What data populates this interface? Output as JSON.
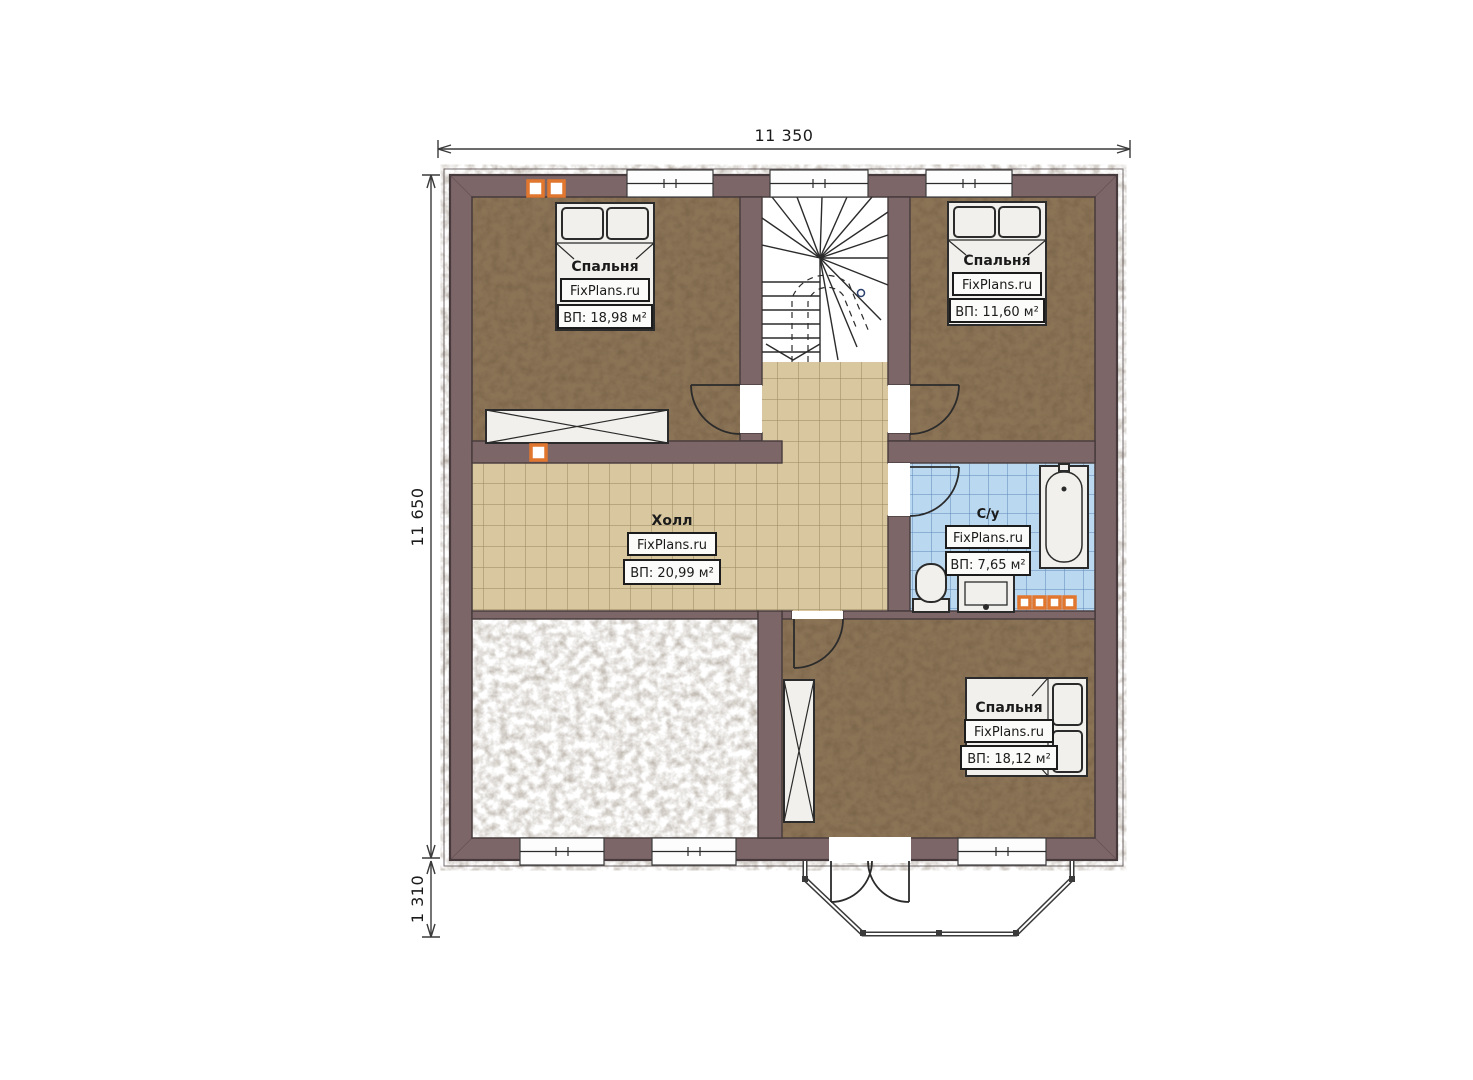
{
  "plan": {
    "dimensions": {
      "top": "11 350",
      "left": "11 650",
      "bottom": "1 310"
    },
    "rooms": [
      {
        "key": "bedroom_top_left",
        "name": "Спальня",
        "brand": "FixPlans.ru",
        "area": "ВП: 18,98 м²"
      },
      {
        "key": "bedroom_top_right",
        "name": "Спальня",
        "brand": "FixPlans.ru",
        "area": "ВП: 11,60 м²"
      },
      {
        "key": "hall",
        "name": "Холл",
        "brand": "FixPlans.ru",
        "area": "ВП: 20,99 м²"
      },
      {
        "key": "bathroom",
        "name": "С/у",
        "brand": "FixPlans.ru",
        "area": "ВП: 7,65 м²"
      },
      {
        "key": "bedroom_bottom_right",
        "name": "Спальня",
        "brand": "FixPlans.ru",
        "area": "ВП: 18,12 м²"
      }
    ],
    "colors": {
      "wall": "#7d6668",
      "wall_edge": "#463a3c",
      "bedroom_floor": "#8b7357",
      "hall_tile": "#d9c79f",
      "hall_grout": "#97865f",
      "bath_tile": "#bad9f1",
      "bath_grout": "#5c88b5",
      "accent_orange": "#e1762f",
      "line": "#2b2b2b"
    }
  }
}
